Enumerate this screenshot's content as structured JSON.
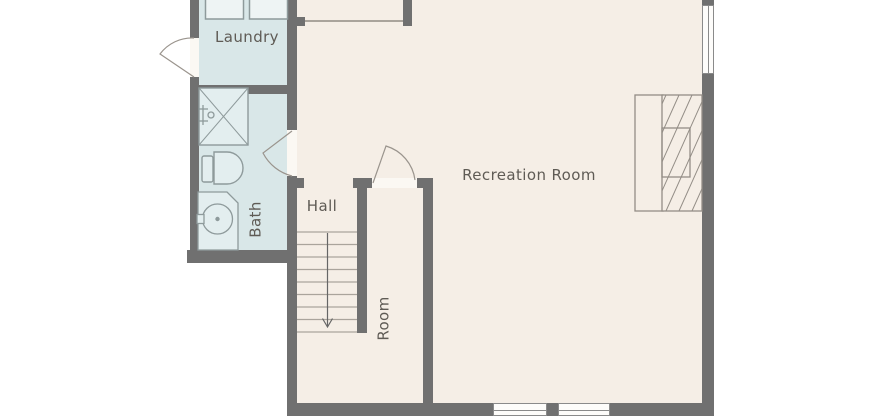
{
  "title": "Basement floor plan",
  "rooms": {
    "laundry": {
      "label": "Laundry"
    },
    "bath": {
      "label": "Bath"
    },
    "hall": {
      "label": "Hall"
    },
    "room": {
      "label": "Room"
    },
    "recreation": {
      "label": "Recreation Room"
    }
  },
  "fixtures": {
    "laundry": [
      "washer-icon",
      "dryer-icon"
    ],
    "bath": [
      "shower-icon",
      "shower-valve-icon",
      "toilet-icon",
      "sink-vanity-icon"
    ],
    "hall": [
      "staircase-down-icon",
      "down-arrow-icon"
    ],
    "recreation": [
      "fireplace-icon"
    ],
    "doors": [
      "laundry-exterior-door",
      "bath-door",
      "room-door"
    ],
    "windows": [
      "right-wall-window",
      "bottom-wall-window-1",
      "bottom-wall-window-2"
    ]
  },
  "colors": {
    "background": "#ffffff",
    "floor": "#f5eee6",
    "wet_floor": "#d9e7e8",
    "wall": "#707070",
    "opening": "#fbf8f3",
    "window_fill": "#fdfcfa",
    "window_stroke": "#8a8a8a",
    "fixture_stroke": "#8e9a9b",
    "masonry_stroke": "#938d86",
    "stair_stroke": "#aaa49c",
    "arrow": "#666666",
    "door_stroke": "#9a948d",
    "appliance_fill": "#eef4f4",
    "fixture_fill": "#e3eeef",
    "text": "#5f5b55"
  }
}
